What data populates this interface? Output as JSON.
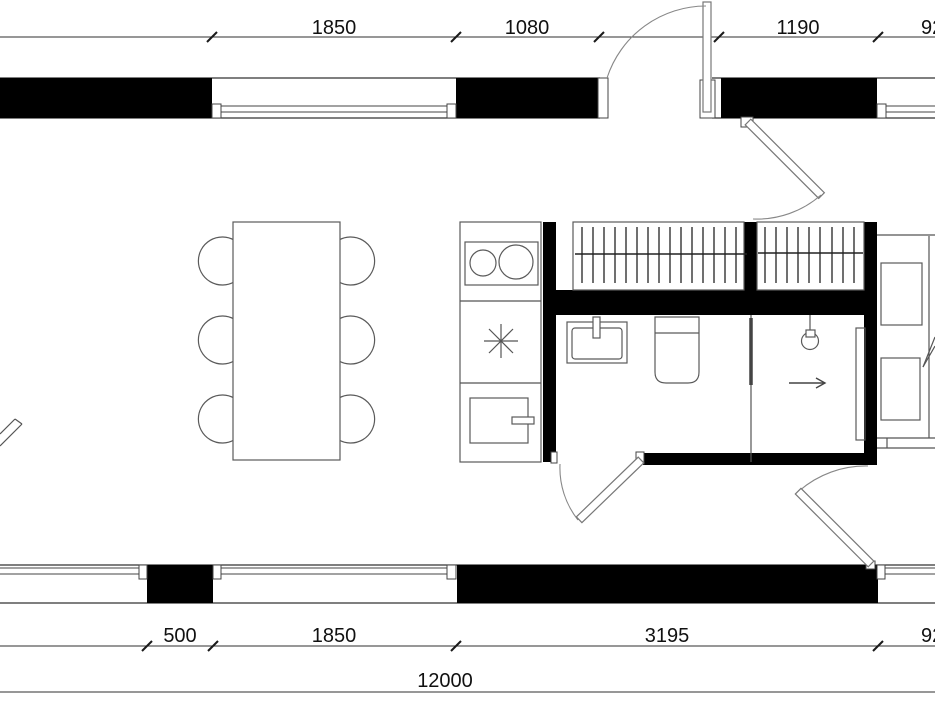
{
  "plan": {
    "type": "architectural-floor-plan",
    "units": "mm",
    "colors": {
      "walls": "#000000",
      "lines": "#333333",
      "fixtures": "#5a5a5a",
      "dimension_text": "#111111",
      "background": "#ffffff"
    },
    "dims": {
      "top": [
        {
          "label": "1850"
        },
        {
          "label": "1080"
        },
        {
          "label": "1190"
        },
        {
          "label": "92"
        }
      ],
      "bottom": [
        {
          "label": "500"
        },
        {
          "label": "1850"
        },
        {
          "label": "3195"
        },
        {
          "label": "92"
        }
      ],
      "overall": {
        "label": "12000"
      }
    },
    "elements": {
      "furniture": [
        "dining-table",
        "six-chairs",
        "kitchen-counter",
        "cooktop-2-burners",
        "extractor-symbol",
        "kitchen-sink",
        "wardrobe-left-hatched",
        "wardrobe-right-hatched",
        "washbasin",
        "toilet",
        "ceiling-lamp",
        "sliding-panel",
        "two-appliances-right"
      ],
      "doors": [
        "entry-door-top",
        "hall-door-45deg",
        "bathroom-door",
        "hall-side-door",
        "left-edge-door-cut"
      ],
      "window_count": 5,
      "direction_arrow": "right"
    }
  }
}
